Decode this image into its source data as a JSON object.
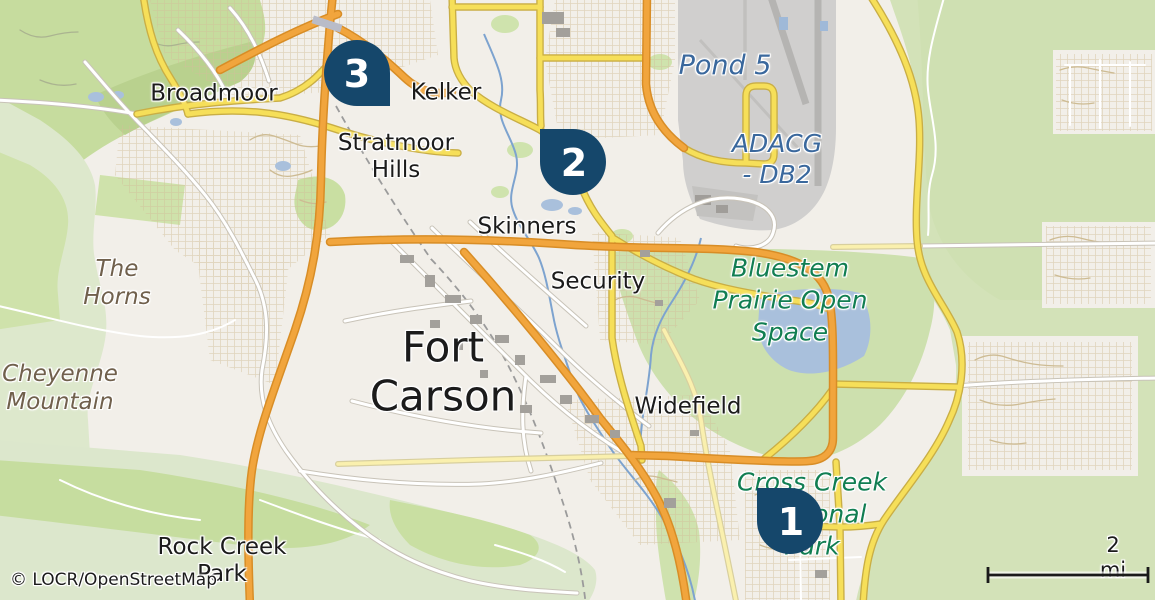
{
  "map": {
    "labels": {
      "broadmoor": {
        "text": "Broadmoor"
      },
      "kelker": {
        "text": "Kelker"
      },
      "stratmoor": {
        "text": "Stratmoor\nHills"
      },
      "skinners": {
        "text": "Skinners"
      },
      "security": {
        "text": "Security"
      },
      "fort_carson": {
        "text": "Fort\nCarson"
      },
      "widefield": {
        "text": "Widefield"
      },
      "pond5": {
        "text": "Pond 5"
      },
      "adacg": {
        "text": "ADACG\n- DB2"
      },
      "bluestem": {
        "text": "Bluestem\nPrairie Open\nSpace"
      },
      "cross_creek": {
        "text": "Cross Creek\nRegional\nPark"
      },
      "the_horns": {
        "text": "The\nHorns"
      },
      "cheyenne": {
        "text": "Cheyenne\nMountain"
      },
      "rock_creek": {
        "text": "Rock Creek\nPark"
      }
    },
    "markers": [
      {
        "number": "1"
      },
      {
        "number": "2"
      },
      {
        "number": "3"
      }
    ],
    "scale": {
      "label": "2 mi"
    },
    "attribution": {
      "text": "© LOCR/OpenStreetMap"
    },
    "colors": {
      "marker_navy": "#15476b",
      "road_orange": "#f1a53d",
      "road_yellow": "#f6df59",
      "water_fill": "#a9c0dc",
      "stream": "#7da3cf",
      "park_label_green": "#117e52",
      "water_label_blue": "#3a689d",
      "mountain_label_brown": "#70604c",
      "background": "#f2efe9",
      "forest_green": "#c6dc9e",
      "airport_gray": "#d0cfce"
    }
  }
}
